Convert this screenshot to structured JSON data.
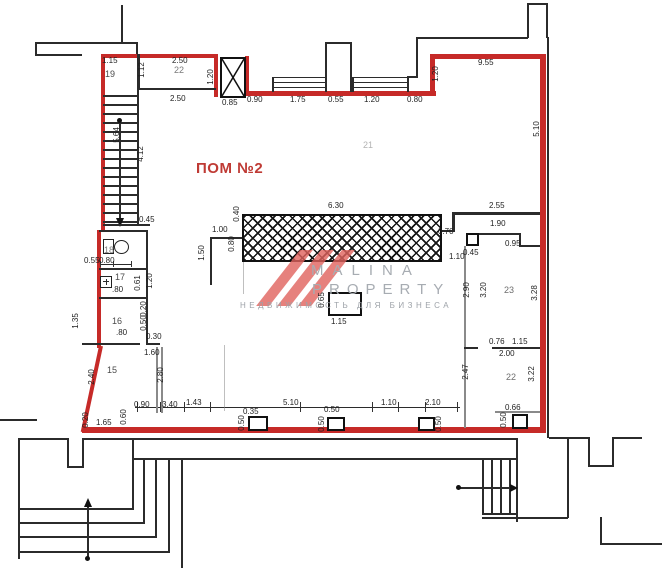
{
  "title": "ПОМ №2",
  "watermark": {
    "brand_top": "MALINA",
    "brand_bottom": "PROPERTY",
    "tagline": "НЕДВИЖИМОСТЬ ДЛЯ БИЗНЕСА"
  },
  "rooms": [
    "19",
    "22",
    "18",
    "17",
    "16",
    "15",
    "21",
    "23",
    "22"
  ],
  "dims": [
    "1.15",
    "2.50",
    "1.12",
    "2.50",
    "5.64",
    "4.12",
    "0.45",
    "1.20",
    "0.85",
    "0.90",
    "1.75",
    "0.55",
    "1.20",
    "0.80",
    "9.55",
    "1.20",
    "5.10",
    "6.30",
    "0.40",
    "1.00",
    "0.80",
    "1.50",
    "2.55",
    "1.90",
    "0.70",
    "0.45",
    "0.95",
    "1.10",
    "2.90",
    "3.20",
    "3.28",
    "0.76",
    "1.15",
    "2.00",
    "2.47",
    "3.22",
    "0.66",
    "0.50",
    "0.65",
    "1.15",
    "0.90",
    "3.40",
    "1.43",
    "5.10",
    "0.35",
    "0.50",
    "0.50",
    "0.50",
    "1.10",
    "2.10",
    "0.50",
    "1.60",
    "2.40",
    "2.80",
    "0.20",
    "1.65",
    "0.60",
    "0.55",
    "0.80",
    ".80",
    "0.61",
    "1.20",
    ".80",
    "1.35",
    "0.20",
    "0.50",
    "0.30"
  ],
  "colors": {
    "boundary_red": "#c62a28",
    "wall_black": "#2b2b2b",
    "title_red": "#bf3a34",
    "watermark_gray": "#a7acb2"
  }
}
